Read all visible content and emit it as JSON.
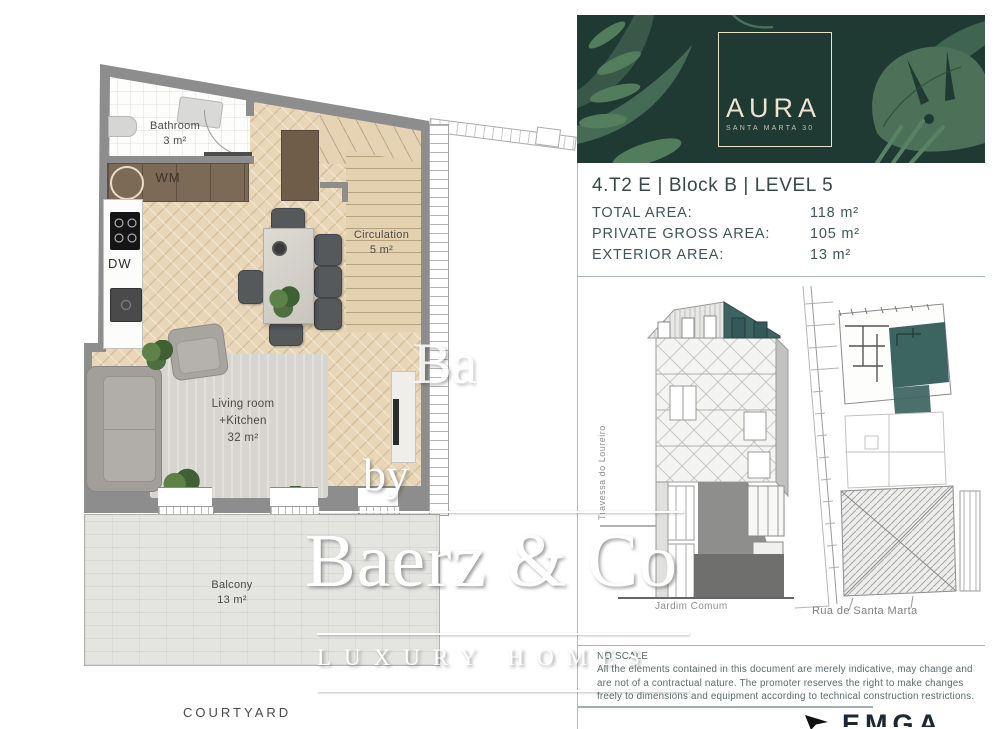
{
  "header": {
    "logo_title": "AURA",
    "logo_subtitle": "SANTA MARTA 30"
  },
  "unit": {
    "title": "4.T2 E | Block B | LEVEL 5"
  },
  "areas": {
    "rows": [
      {
        "label": "TOTAL AREA:",
        "value": "118 m²"
      },
      {
        "label": "PRIVATE GROSS AREA:",
        "value": "105 m²"
      },
      {
        "label": "EXTERIOR AREA:",
        "value": "13 m²"
      }
    ]
  },
  "floorplan": {
    "bathroom": {
      "name": "Bathroom",
      "area": "3 m²"
    },
    "appliances": {
      "wm": "WM",
      "dw": "DW"
    },
    "circulation": {
      "name": "Circulation",
      "area": "5 m²"
    },
    "living": {
      "line1": "Living room",
      "line2": "+Kitchen",
      "area": "32 m²"
    },
    "balcony": {
      "name": "Balcony",
      "area": "13 m²"
    },
    "courtyard": "COURTYARD"
  },
  "drawings": {
    "street_side_label": "Travessa do Loureiro",
    "section_caption": "Jardim Comum",
    "siteplan_caption": "Rua de Santa Marta"
  },
  "disclaimer": {
    "line1": "NO SCALE",
    "line2": "All the elements contained in this document are merely indicative, may change and",
    "line3": "are not of a contractual nature. The promoter reserves the right to make changes",
    "line4": "freely to dimensions and equipment according to technical construction restrictions."
  },
  "watermark": {
    "by": "by",
    "brand": "Baerz & Co",
    "brand_partial": "Ba",
    "tagline": "LUXURY HOMES"
  },
  "partner": {
    "logo_text": "EMGA"
  },
  "colors": {
    "banner_green": "#1f3a32",
    "accent_teal": "#3c6460",
    "cream": "#e9e1cc",
    "wall_gray": "#8d8d8d",
    "floor_beige": "#e9d6b6",
    "text_teal": "#405656",
    "line_teal": "#a8b6b4"
  }
}
